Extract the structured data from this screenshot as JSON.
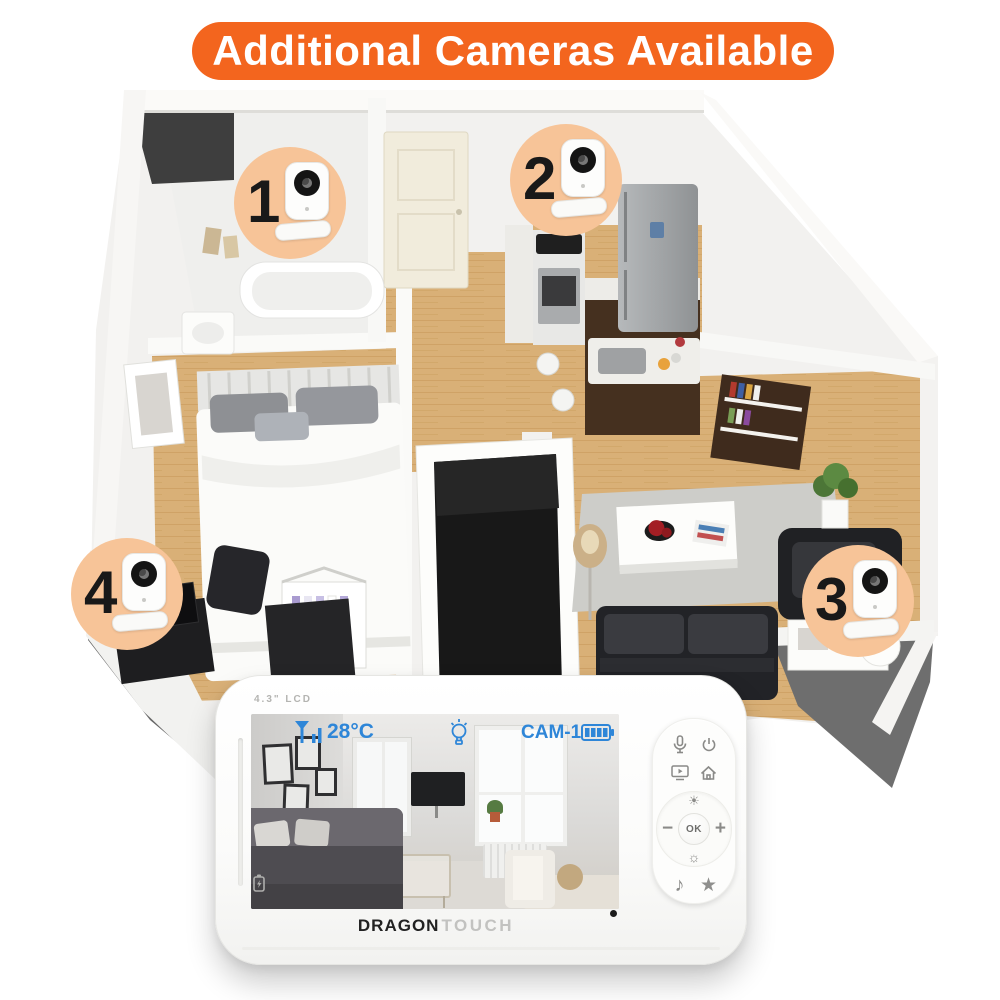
{
  "banner": {
    "text": "Additional Cameras Available"
  },
  "cameras": [
    {
      "number": "1"
    },
    {
      "number": "2"
    },
    {
      "number": "3"
    },
    {
      "number": "4"
    }
  ],
  "monitor": {
    "lcd_label": "4.3\" LCD",
    "osd": {
      "temperature": "28°C",
      "camera_label": "CAM-1",
      "icons": [
        "signal-strength-icon",
        "light-bulb-icon",
        "battery-level-icon"
      ]
    },
    "controls": {
      "ok": "OK",
      "plus": "+",
      "minus": "−",
      "brightness_up": "☀",
      "brightness_down": "☼",
      "music": "♪",
      "star": "★",
      "icons": [
        "microphone-icon",
        "power-icon",
        "screen-play-icon",
        "home-icon"
      ]
    },
    "brand": {
      "primary": "DRAGON",
      "secondary": "TOUCH"
    }
  },
  "colors": {
    "banner_bg": "#F3651E",
    "osd_blue": "#2E86D8",
    "camera_circle": "#F7C498",
    "wood_floor": "#D6AC72",
    "platform_gray": "#6B6B6B",
    "brand_dark": "#222222",
    "brand_light": "#C2C2C0"
  }
}
